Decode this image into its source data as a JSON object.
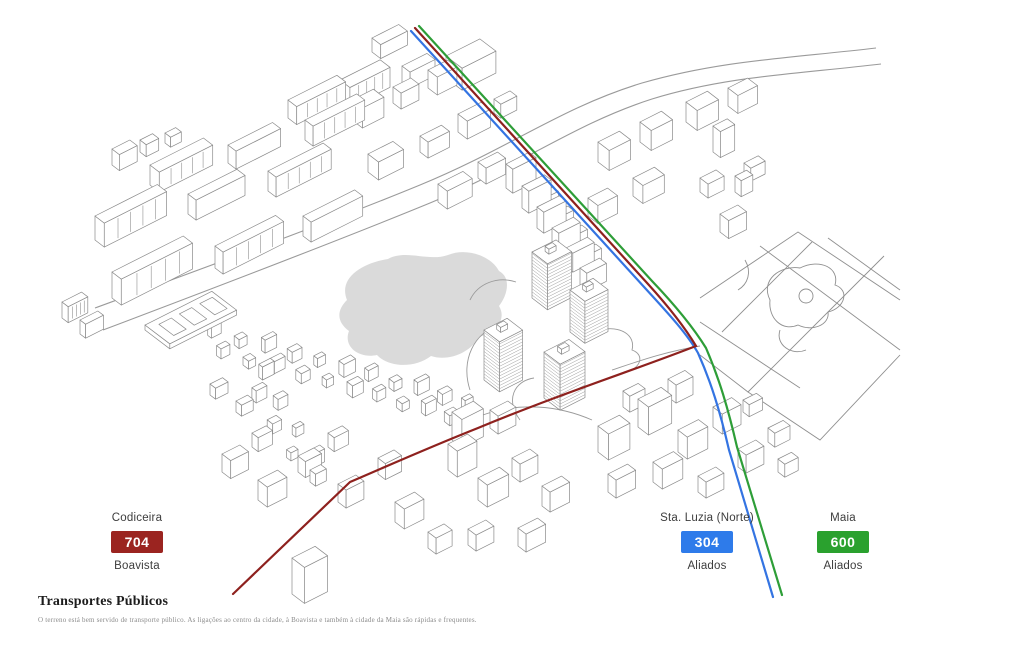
{
  "legend": [
    {
      "origin": "Codiceira",
      "number": "704",
      "destination": "Boavista",
      "badge_color": "#9b2420",
      "line_color": "#8e211e"
    },
    {
      "origin": "Sta. Luzia (Norte)",
      "number": "304",
      "destination": "Aliados",
      "badge_color": "#2e7bea",
      "line_color": "#3474e2"
    },
    {
      "origin": "Maia",
      "number": "600",
      "destination": "Aliados",
      "badge_color": "#2aa12e",
      "line_color": "#2e9e38"
    }
  ],
  "footer": {
    "title": "Transportes Públicos",
    "description": "O terreno está bem servido de transporte público. As ligações ao centro da cidade, à Boavista e também à cidade da Maia são rápidas e frequentes."
  },
  "map": {
    "pond_color": "#dadada",
    "outline_color": "#8a8a8a"
  }
}
